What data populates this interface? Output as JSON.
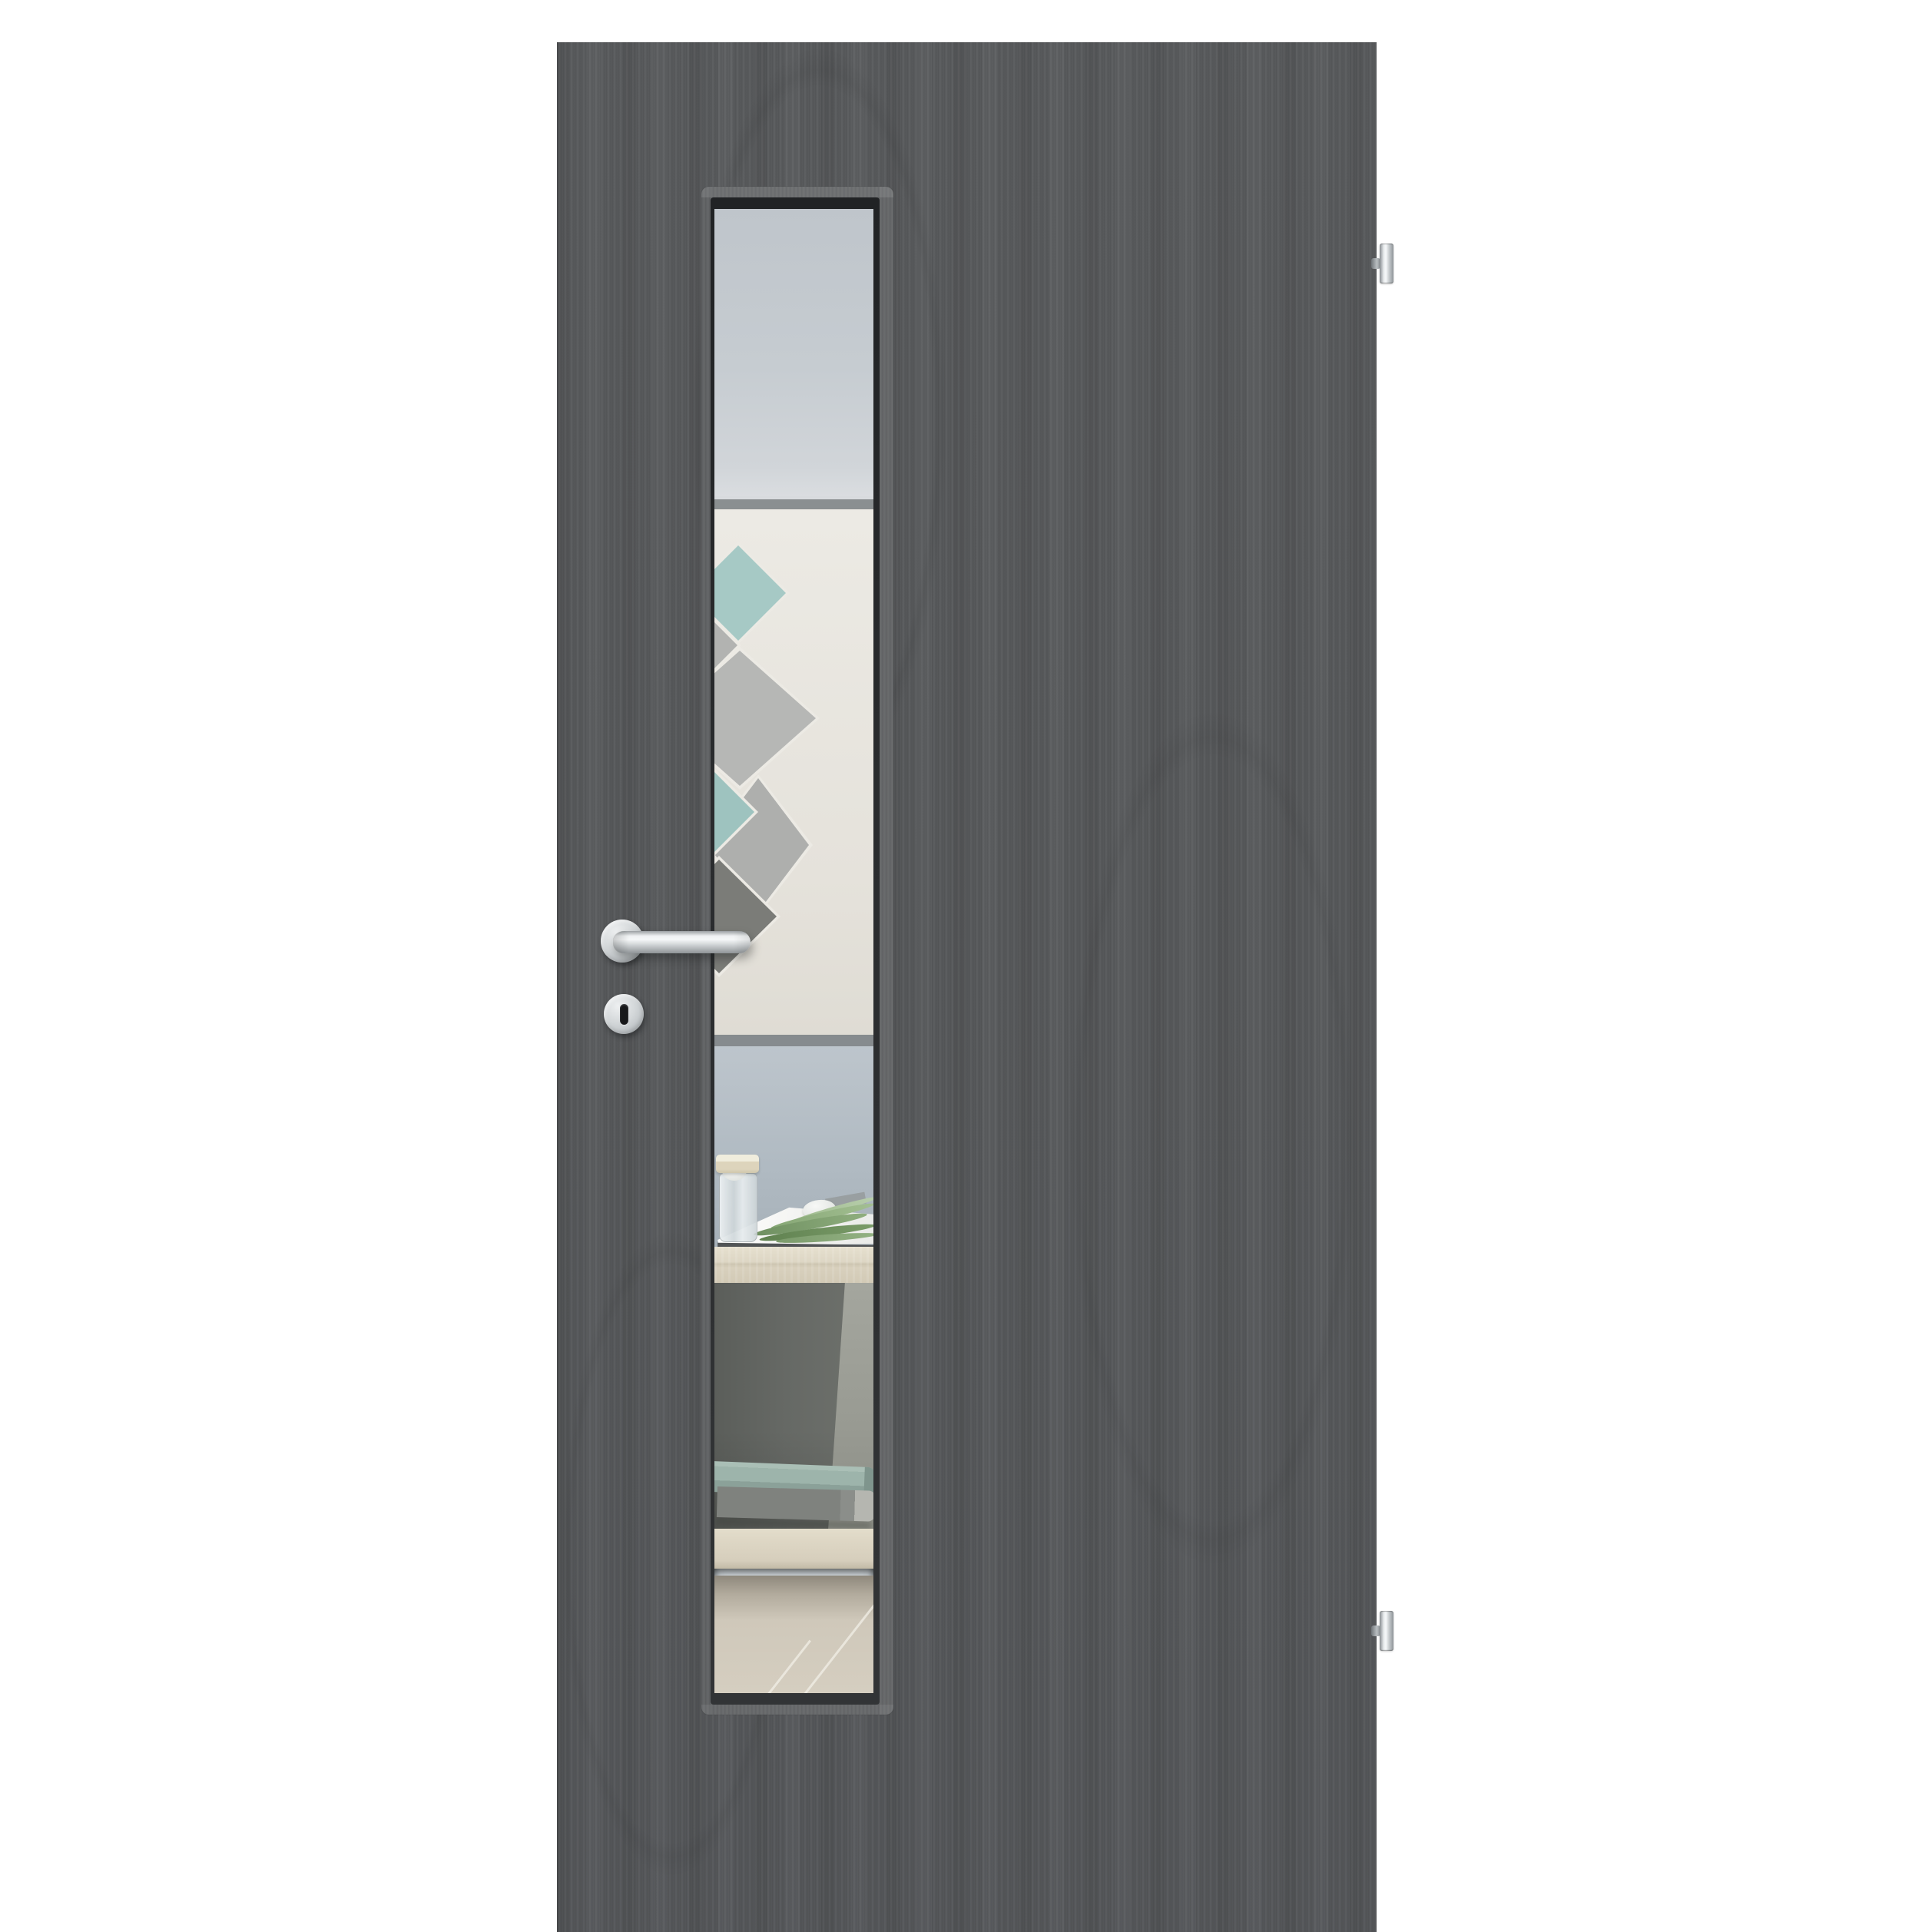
{
  "image": {
    "kind": "product photo",
    "label": "Interior door with vertical glazing cutout, dark grey wood-grain finish, stainless steel fittings, hinges on the right (DIN right)",
    "background_color": "#ffffff",
    "visible_text": "none"
  },
  "door": {
    "label": "Door leaf, dark grey pine-structure laminate with vertical grain",
    "face_color": "#57595b",
    "grain_direction": "vertical",
    "hinge_side": "right"
  },
  "glazing": {
    "label": "Narrow vertical lite (glass cutout) set left of centre",
    "frame_color": "#5b5d5f",
    "recess_shadow_color": "#26282a",
    "glass_top_tint": "#c4cacf"
  },
  "scene_through_glass": {
    "label": "Room interior visible through the clear glass",
    "upper_wall_color": "#c6ccd1",
    "art_panel": {
      "label": "White wall panel with overlapping diamond pattern",
      "panel_color": "#eceae4",
      "edge_bar_color": "#8a8f91",
      "diamond_colors": [
        "#a6c9c5",
        "#b2b3b1",
        "#b6b7b5",
        "#9ec3bf",
        "#aeafad",
        "#7b7c78"
      ]
    },
    "lower_wall_color": "#b0bac2",
    "desk": {
      "label": "Light wood sideboard / desk",
      "top_color": "#ddd6c4",
      "compartment_color": "#63665f",
      "shelf_color": "#ddd6c4"
    },
    "still_life": {
      "jar": {
        "label": "Glass jar with cream lid",
        "lid_color": "#ddd4bc",
        "glass_color": "#ccd4d7"
      },
      "egg": {
        "label": "White egg shell",
        "color": "#eef0ee"
      },
      "magazine": {
        "label": "Open magazine lying flat",
        "page_color": "#ffffff",
        "edge_color": "#515456"
      },
      "leaves": {
        "label": "Green palm leaf on magazine",
        "colors": [
          "#6e8f60",
          "#85a674",
          "#5f814f",
          "#9cb98a"
        ]
      }
    },
    "books": {
      "label": "Two books stacked in open compartment",
      "colors": [
        "#9db4ab",
        "#7f827e"
      ]
    },
    "floor": {
      "label": "Beige tile floor with diagonal joints",
      "color": "#cfc8ba",
      "joint_color": "#f2efe7"
    }
  },
  "hardware": {
    "finish_color": "#d3d7d9",
    "lever_handle": {
      "label": "Stainless steel L-form lever handle on round rose"
    },
    "handle_rose": {
      "label": "Round handle rosette"
    },
    "key_escutcheon": {
      "label": "Round key escutcheon with buntbart keyhole",
      "keyhole_color": "#17181a"
    },
    "hinges": {
      "label": "Stainless steel barrel hinges on right edge",
      "count": 2
    }
  }
}
